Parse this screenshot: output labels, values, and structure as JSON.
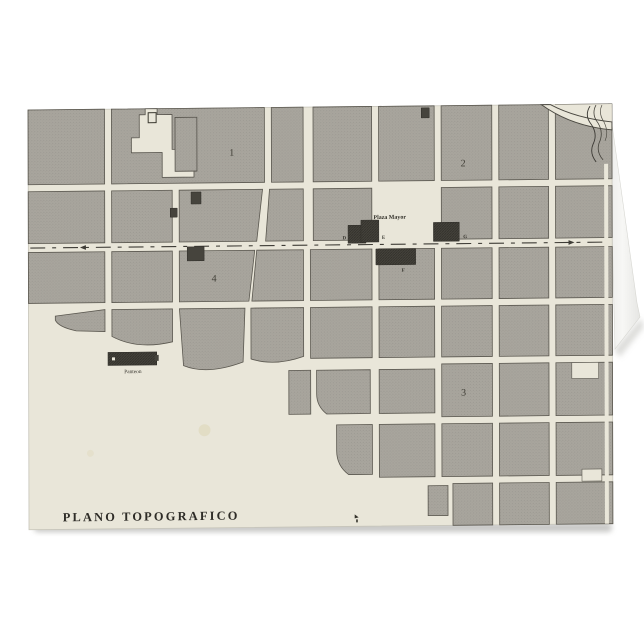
{
  "card": {
    "title": "PLANO TOPOGRAFICO",
    "map_labels": {
      "plaza": "Plaza Mayor",
      "panteon": "Panteon"
    },
    "district_numbers": {
      "d1": "1",
      "d2": "2",
      "d3": "3",
      "d4": "4"
    },
    "building_letters": {
      "d": "D",
      "e": "E",
      "f": "F",
      "g": "G"
    },
    "colors": {
      "background": "#ffffff",
      "paper": "#e9e6d9",
      "block_gray": "#a8a59d",
      "street": "#e4e1d4",
      "building_dark": "#46443d",
      "ink": "#2e2c27"
    }
  }
}
